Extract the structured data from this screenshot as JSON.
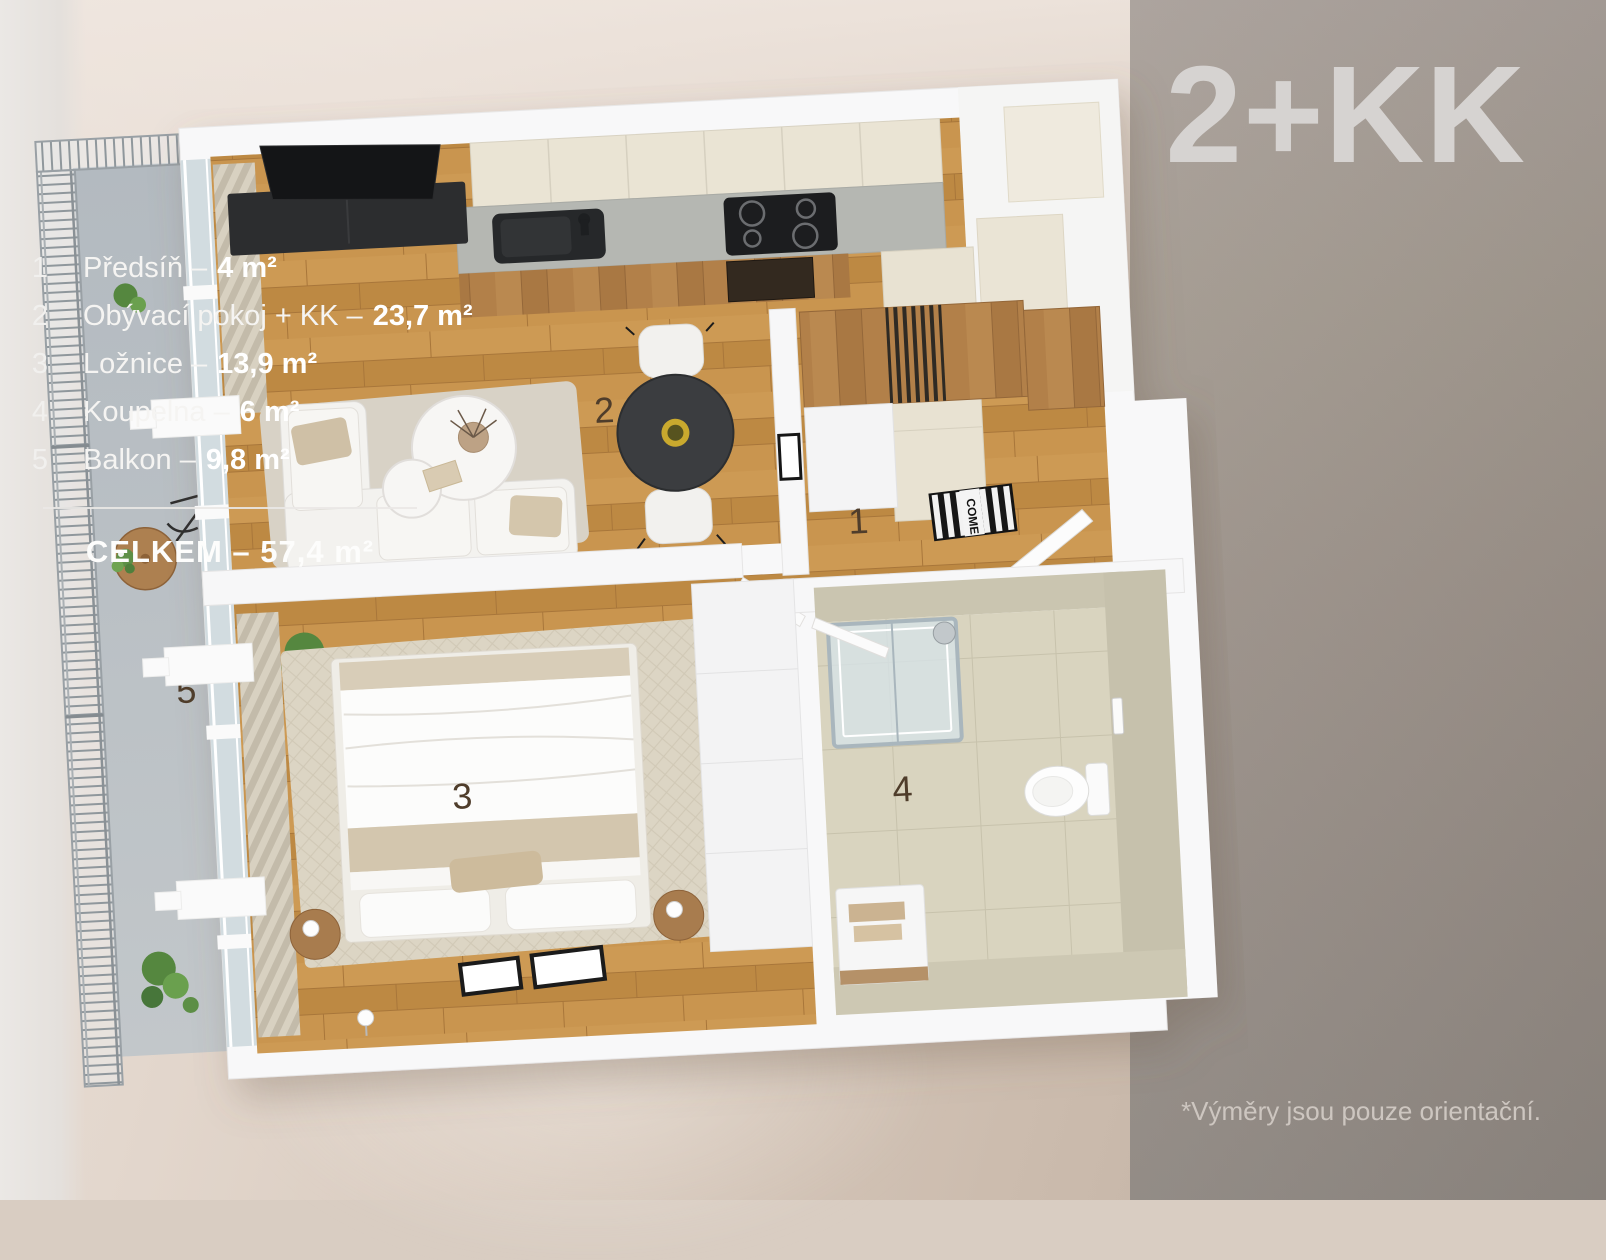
{
  "title": "2+KK",
  "legend": {
    "items": [
      {
        "num": "1",
        "label": "Předsíň –",
        "area": "4 m²"
      },
      {
        "num": "2",
        "label": "Obývací pokoj + KK –",
        "area": "23,7 m²"
      },
      {
        "num": "3",
        "label": "Ložnice –",
        "area": "13,9 m²"
      },
      {
        "num": "4",
        "label": "Koupelna –",
        "area": "6 m²"
      },
      {
        "num": "5",
        "label": "Balkon –",
        "area": "9,8 m²"
      }
    ],
    "total": "CELKEM – 57,4 m²"
  },
  "floorplan": {
    "type": "3d-floor-plan-top-view",
    "room_labels": [
      {
        "num": "1",
        "room": "Předsíň"
      },
      {
        "num": "2",
        "room": "Obývací pokoj + KK"
      },
      {
        "num": "3",
        "room": "Ložnice"
      },
      {
        "num": "4",
        "room": "Koupelna"
      },
      {
        "num": "5",
        "room": "Balkon"
      }
    ],
    "mat_text": "COME"
  },
  "disclaimer": "*Výměry jsou pouze orientační.",
  "colors": {
    "panel": "#9b9189",
    "title": "#d6d3d1",
    "legend_text": "#f5f4f2",
    "wood_floor": "#c6924b",
    "room_label": "#4f3d2b",
    "background": "#d9cdc2",
    "balcony_floor": "#b8bec2",
    "bathroom_tile": "#d9d4bf"
  }
}
